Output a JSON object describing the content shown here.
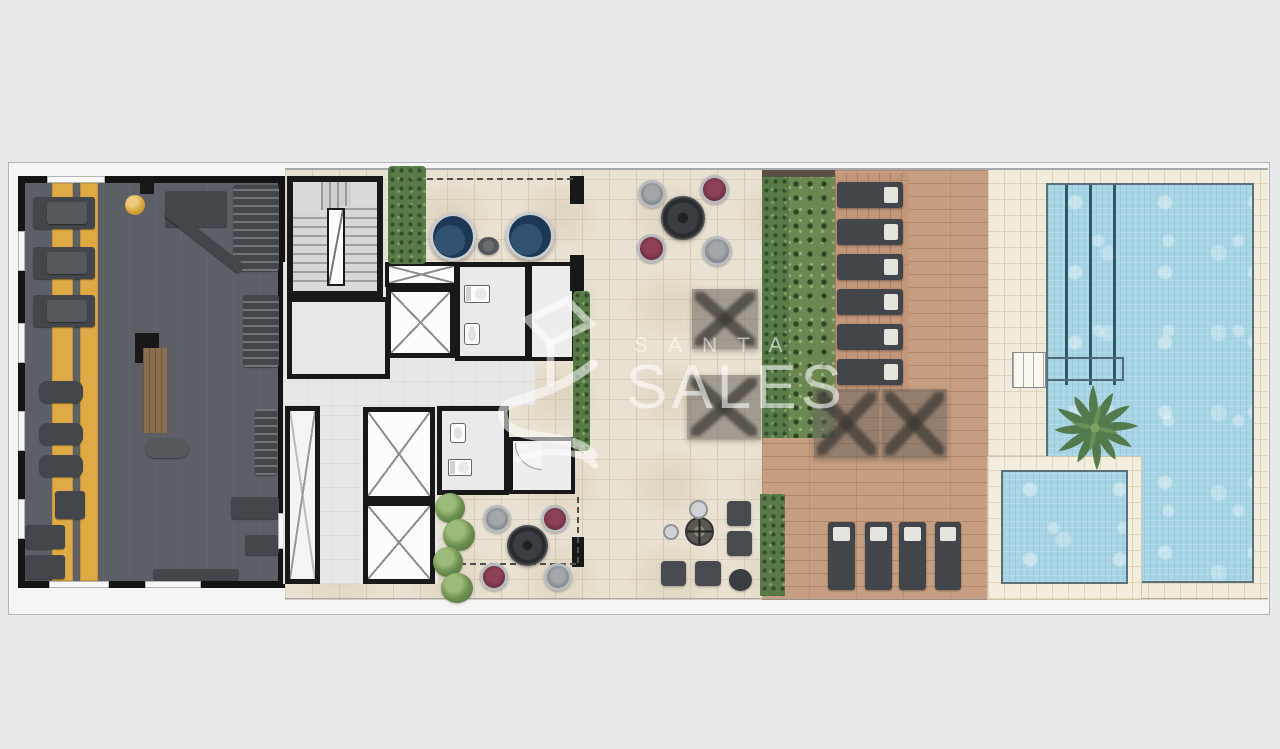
{
  "watermark": {
    "brand_line_top": "SANTA",
    "brand_line_bottom": "SALES"
  },
  "palette": {
    "background": "#e8e9ea",
    "walls": "#181818",
    "gym_floor": "#5c6066",
    "gym_stripes": "#dfa943",
    "stone_terrace": "#e9e1d2",
    "wood_deck": "#c79e81",
    "pool_deck": "#f1ebdb",
    "pool_water": "#a7d5e5",
    "hedge_green": "#587a48",
    "chair_maroon": "#7c3448",
    "chair_gray": "#8f9397",
    "daybed_navy": "#1d3854",
    "furniture_dark": "#43464b"
  },
  "areas": {
    "gym": {
      "treadmills": 3,
      "spin_bikes": 3,
      "strength_stations": 6,
      "benches": 2
    },
    "core": {
      "staircases": 1,
      "elevators": 4,
      "bathrooms": 2,
      "service_shafts": 1
    },
    "terrace": {
      "round_daybeds": 2,
      "dining_sets": 2,
      "shaded_daybeds": 2,
      "grills": 1,
      "poufs": 5
    },
    "deck": {
      "sun_loungers": 10,
      "umbrellas": 2
    },
    "pool": {
      "pools": 2,
      "lap_lanes": 3,
      "palm_trees": 1
    }
  }
}
